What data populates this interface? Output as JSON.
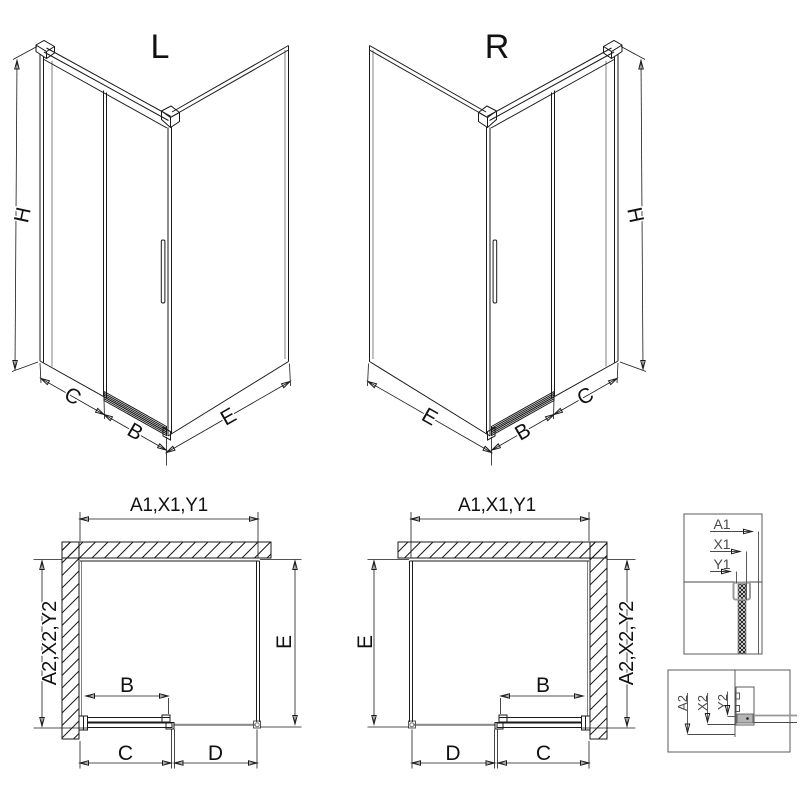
{
  "iso_left": {
    "label": "L",
    "dim_height": "H",
    "dim_fixed": "C",
    "dim_door": "B",
    "dim_side": "E"
  },
  "iso_right": {
    "label": "R",
    "dim_height": "H",
    "dim_fixed": "C",
    "dim_door": "B",
    "dim_side": "E"
  },
  "plan_left": {
    "dim_width": "A1,X1,Y1",
    "dim_install": "A2,X2,Y2",
    "dim_side": "E",
    "dim_door": "B",
    "dim_c": "C",
    "dim_d": "D"
  },
  "plan_right": {
    "dim_width": "A1,X1,Y1",
    "dim_install": "A2,X2,Y2",
    "dim_side": "E",
    "dim_door": "B",
    "dim_c": "C",
    "dim_d": "D"
  },
  "detail_glass": {
    "labels": [
      "A1",
      "X1",
      "Y1"
    ]
  },
  "detail_floor": {
    "labels": [
      "A2",
      "X2",
      "Y2"
    ]
  },
  "colors": {
    "line": "#1a1a1a",
    "detail_line": "#4a4a4a",
    "profile_gray": "#b5b5b5",
    "track_gray": "#8a8a8a",
    "background": "#ffffff"
  }
}
